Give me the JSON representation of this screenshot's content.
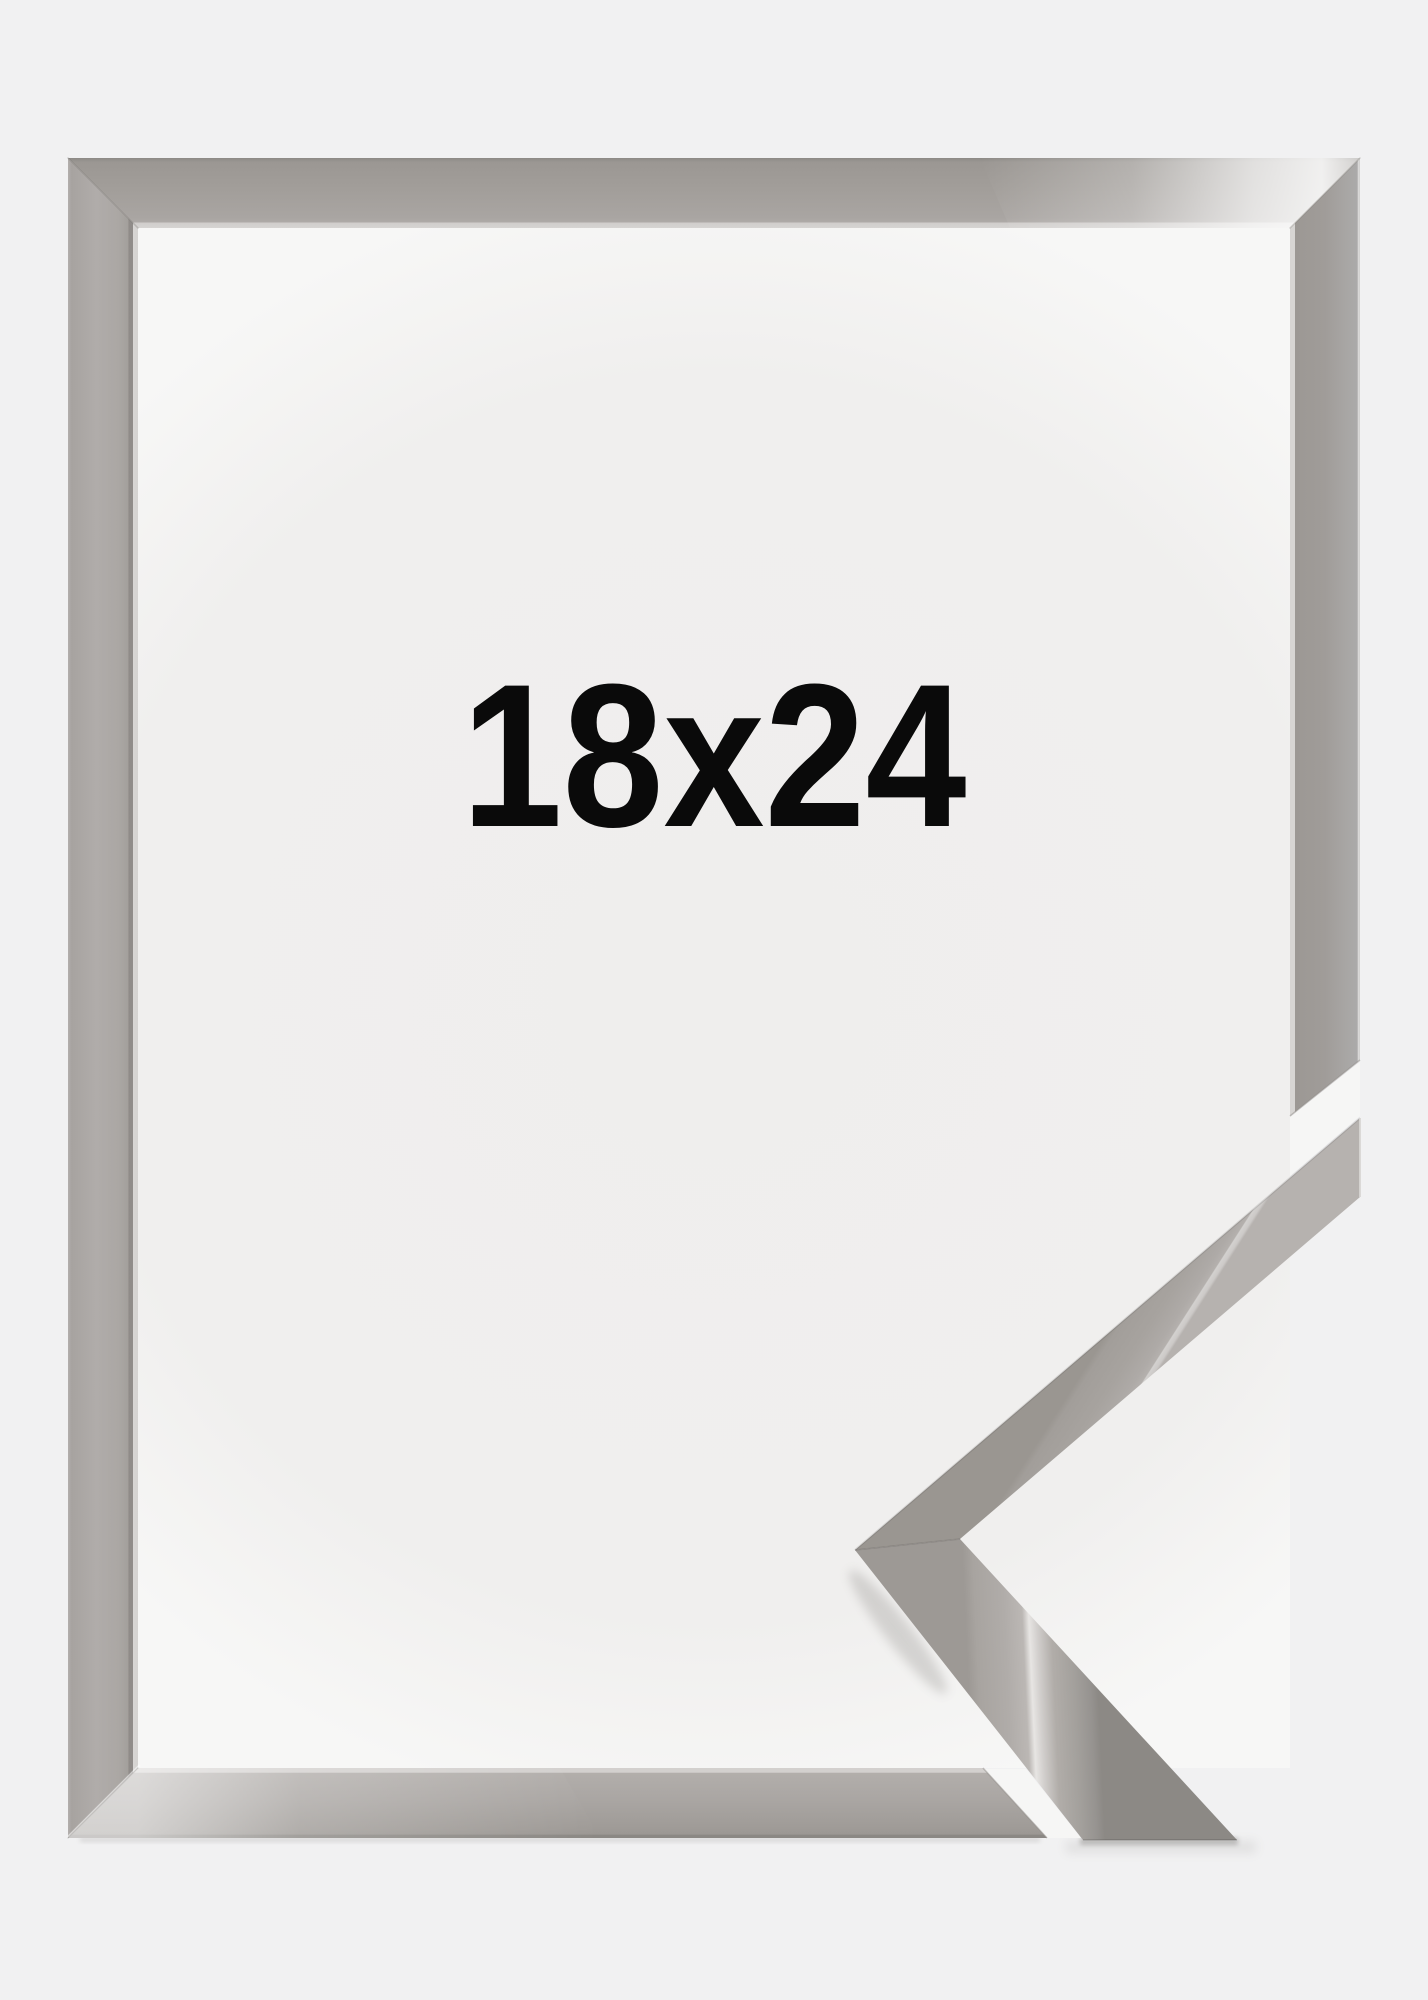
{
  "product_image": {
    "size_label": "18x24",
    "label_color": "#0a0a0a",
    "background_color": "#f1f1f2",
    "frame_colors": {
      "base": "#a5a19d",
      "light_bevel": "#d6d4d2",
      "dark_edge": "#8b8784",
      "gloss_highlight": "#ffffff"
    }
  }
}
